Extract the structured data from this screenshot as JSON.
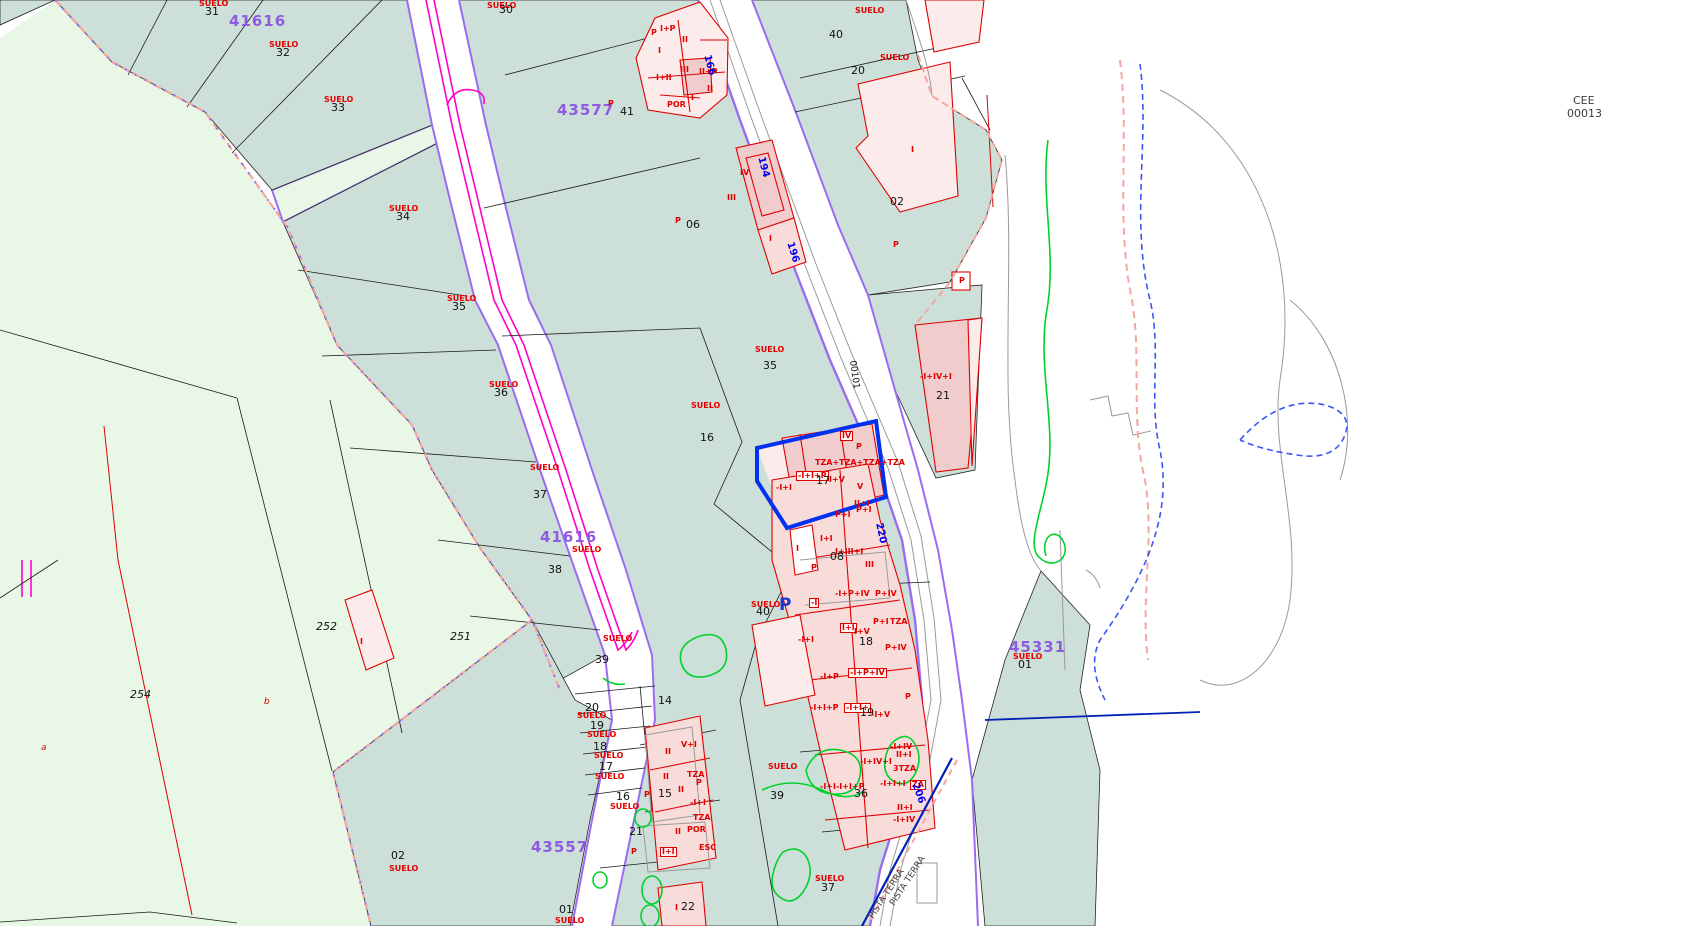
{
  "corner": {
    "line1": "CEE",
    "line2": "00013"
  },
  "selection": {
    "parcel_number": "17",
    "building_label": "I+V",
    "outline_color": "#0030f0"
  },
  "colors": {
    "urban": "#ccdfd8",
    "rural": "#e9f8e6",
    "building": "#f7dcda",
    "building-strong": "#f0cccc",
    "building-light": "#fbeceb",
    "outline-red": "#e00000",
    "suelo-red": "#e80000",
    "violet": "#9a6cf0",
    "block-purple": "#8f5ce0",
    "magenta": "#ff00c8",
    "road-blue": "#0000f0",
    "selection-blue": "#0030f0",
    "navy": "#0020b8",
    "royal": "#3a55f5",
    "green": "#00d22d",
    "boundary-salmon": "#f2a79f",
    "gray": "#9a9a9a",
    "ink": "#111111"
  },
  "labels": [
    {
      "t": "SUELO",
      "x": 199,
      "y": 0,
      "k": "s"
    },
    {
      "t": "31",
      "x": 205,
      "y": 6,
      "k": "n"
    },
    {
      "t": "SUELO",
      "x": 269,
      "y": 41,
      "k": "s"
    },
    {
      "t": "32",
      "x": 276,
      "y": 47,
      "k": "n"
    },
    {
      "t": "SUELO",
      "x": 324,
      "y": 96,
      "k": "s"
    },
    {
      "t": "33",
      "x": 331,
      "y": 102,
      "k": "n"
    },
    {
      "t": "SUELO",
      "x": 389,
      "y": 205,
      "k": "s"
    },
    {
      "t": "34",
      "x": 396,
      "y": 211,
      "k": "n"
    },
    {
      "t": "SUELO",
      "x": 447,
      "y": 295,
      "k": "s"
    },
    {
      "t": "35",
      "x": 452,
      "y": 301,
      "k": "n"
    },
    {
      "t": "SUELO",
      "x": 489,
      "y": 381,
      "k": "s"
    },
    {
      "t": "36",
      "x": 494,
      "y": 387,
      "k": "n"
    },
    {
      "t": "SUELO",
      "x": 530,
      "y": 464,
      "k": "s"
    },
    {
      "t": "37",
      "x": 533,
      "y": 489,
      "k": "n"
    },
    {
      "t": "SUELO",
      "x": 572,
      "y": 546,
      "k": "s"
    },
    {
      "t": "38",
      "x": 548,
      "y": 564,
      "k": "n"
    },
    {
      "t": "SUELO",
      "x": 603,
      "y": 635,
      "k": "s"
    },
    {
      "t": "39",
      "x": 595,
      "y": 654,
      "k": "n"
    },
    {
      "t": "SUELO",
      "x": 487,
      "y": 2,
      "k": "s"
    },
    {
      "t": "30",
      "x": 499,
      "y": 4,
      "k": "n"
    },
    {
      "t": "41616",
      "x": 229,
      "y": 14,
      "k": "b"
    },
    {
      "t": "43577",
      "x": 557,
      "y": 103,
      "k": "b"
    },
    {
      "t": "41616",
      "x": 540,
      "y": 530,
      "k": "b"
    },
    {
      "t": "45331",
      "x": 1009,
      "y": 640,
      "k": "b"
    },
    {
      "t": "43557",
      "x": 531,
      "y": 840,
      "k": "b"
    },
    {
      "t": "SUELO",
      "x": 1013,
      "y": 653,
      "k": "s"
    },
    {
      "t": "01",
      "x": 1018,
      "y": 659,
      "k": "n"
    },
    {
      "t": "P",
      "x": 608,
      "y": 100,
      "k": "c"
    },
    {
      "t": "41",
      "x": 620,
      "y": 106,
      "k": "n"
    },
    {
      "t": "P",
      "x": 675,
      "y": 217,
      "k": "c"
    },
    {
      "t": "06",
      "x": 686,
      "y": 219,
      "k": "n"
    },
    {
      "t": "SUELO",
      "x": 755,
      "y": 346,
      "k": "s"
    },
    {
      "t": "35",
      "x": 763,
      "y": 360,
      "k": "n"
    },
    {
      "t": "SUELO",
      "x": 691,
      "y": 402,
      "k": "s"
    },
    {
      "t": "16",
      "x": 700,
      "y": 432,
      "k": "n"
    },
    {
      "t": "SUELO",
      "x": 855,
      "y": 7,
      "k": "s"
    },
    {
      "t": "40",
      "x": 829,
      "y": 29,
      "k": "n"
    },
    {
      "t": "SUELO",
      "x": 880,
      "y": 54,
      "k": "s"
    },
    {
      "t": "20",
      "x": 851,
      "y": 65,
      "k": "n"
    },
    {
      "t": "02",
      "x": 890,
      "y": 196,
      "k": "n"
    },
    {
      "t": "P",
      "x": 893,
      "y": 241,
      "k": "c"
    },
    {
      "t": "I",
      "x": 911,
      "y": 146,
      "k": "c"
    },
    {
      "t": "P",
      "x": 959,
      "y": 277,
      "k": "c"
    },
    {
      "t": "-I+IV+I",
      "x": 920,
      "y": 373,
      "k": "c"
    },
    {
      "t": "21",
      "x": 936,
      "y": 390,
      "k": "n"
    },
    {
      "t": "P",
      "x": 856,
      "y": 443,
      "k": "c"
    },
    {
      "t": "P",
      "x": 651,
      "y": 29,
      "k": "c"
    },
    {
      "t": "I+P",
      "x": 660,
      "y": 25,
      "k": "c"
    },
    {
      "t": "II",
      "x": 682,
      "y": 36,
      "k": "c"
    },
    {
      "t": "I",
      "x": 658,
      "y": 47,
      "k": "c"
    },
    {
      "t": "I+II",
      "x": 656,
      "y": 74,
      "k": "c"
    },
    {
      "t": "III",
      "x": 680,
      "y": 66,
      "k": "c"
    },
    {
      "t": "II+P",
      "x": 699,
      "y": 68,
      "k": "c"
    },
    {
      "t": "I",
      "x": 691,
      "y": 94,
      "k": "c"
    },
    {
      "t": "II",
      "x": 707,
      "y": 85,
      "k": "c"
    },
    {
      "t": "POR",
      "x": 667,
      "y": 101,
      "k": "c"
    },
    {
      "t": "IV",
      "x": 740,
      "y": 169,
      "k": "c"
    },
    {
      "t": "III",
      "x": 727,
      "y": 194,
      "k": "c"
    },
    {
      "t": "I",
      "x": 769,
      "y": 235,
      "k": "c"
    },
    {
      "t": "TZA+TZA+TZA+TZA",
      "x": 815,
      "y": 459,
      "k": "c"
    },
    {
      "t": "-I+I+P",
      "x": 796,
      "y": 471,
      "k": "cb"
    },
    {
      "t": "17",
      "x": 816,
      "y": 475,
      "k": "n"
    },
    {
      "t": "I+V",
      "x": 829,
      "y": 476,
      "k": "c"
    },
    {
      "t": "-I+I",
      "x": 776,
      "y": 484,
      "k": "c"
    },
    {
      "t": "IV",
      "x": 840,
      "y": 431,
      "k": "cb"
    },
    {
      "t": "V",
      "x": 857,
      "y": 483,
      "k": "c"
    },
    {
      "t": "II+I",
      "x": 854,
      "y": 500,
      "k": "c"
    },
    {
      "t": "P+I",
      "x": 835,
      "y": 511,
      "k": "c"
    },
    {
      "t": "P+I",
      "x": 856,
      "y": 506,
      "k": "c"
    },
    {
      "t": "I+I",
      "x": 820,
      "y": 535,
      "k": "c"
    },
    {
      "t": "I+III+I",
      "x": 835,
      "y": 548,
      "k": "c"
    },
    {
      "t": "I",
      "x": 796,
      "y": 545,
      "k": "c"
    },
    {
      "t": "P",
      "x": 811,
      "y": 564,
      "k": "c"
    },
    {
      "t": "III",
      "x": 865,
      "y": 561,
      "k": "c"
    },
    {
      "t": "08",
      "x": 830,
      "y": 551,
      "k": "n"
    },
    {
      "t": "SUELO",
      "x": 751,
      "y": 601,
      "k": "s"
    },
    {
      "t": "40",
      "x": 756,
      "y": 606,
      "k": "n"
    },
    {
      "t": "P",
      "x": 779,
      "y": 597,
      "k": "bp"
    },
    {
      "t": "-I",
      "x": 809,
      "y": 598,
      "k": "cb"
    },
    {
      "t": "-I+P+IV",
      "x": 835,
      "y": 590,
      "k": "c"
    },
    {
      "t": "P+IV",
      "x": 875,
      "y": 590,
      "k": "c"
    },
    {
      "t": "P+I",
      "x": 873,
      "y": 618,
      "k": "c"
    },
    {
      "t": "TZA",
      "x": 890,
      "y": 618,
      "k": "c"
    },
    {
      "t": "I+I",
      "x": 840,
      "y": 623,
      "k": "cb"
    },
    {
      "t": "I+V",
      "x": 854,
      "y": 628,
      "k": "c"
    },
    {
      "t": "18",
      "x": 859,
      "y": 636,
      "k": "n"
    },
    {
      "t": "-I+I",
      "x": 798,
      "y": 636,
      "k": "c"
    },
    {
      "t": "P+IV",
      "x": 885,
      "y": 644,
      "k": "c"
    },
    {
      "t": "-I+P+IV",
      "x": 848,
      "y": 668,
      "k": "cb"
    },
    {
      "t": "-I+P",
      "x": 820,
      "y": 673,
      "k": "c"
    },
    {
      "t": "-I+I+P",
      "x": 810,
      "y": 704,
      "k": "c"
    },
    {
      "t": "-I+I+",
      "x": 844,
      "y": 703,
      "k": "cb"
    },
    {
      "t": "19",
      "x": 860,
      "y": 707,
      "k": "n"
    },
    {
      "t": "-I+V",
      "x": 871,
      "y": 711,
      "k": "c"
    },
    {
      "t": "P",
      "x": 905,
      "y": 693,
      "k": "c"
    },
    {
      "t": "-I+IV",
      "x": 890,
      "y": 743,
      "k": "c"
    },
    {
      "t": "II+I",
      "x": 896,
      "y": 751,
      "k": "c"
    },
    {
      "t": "-I+IV+I",
      "x": 860,
      "y": 758,
      "k": "c"
    },
    {
      "t": "3TZA",
      "x": 893,
      "y": 765,
      "k": "c"
    },
    {
      "t": "-I+I+I",
      "x": 880,
      "y": 780,
      "k": "c"
    },
    {
      "t": "ZA",
      "x": 910,
      "y": 780,
      "k": "cb"
    },
    {
      "t": "-I+I-I+I+P",
      "x": 820,
      "y": 783,
      "k": "c"
    },
    {
      "t": "36",
      "x": 854,
      "y": 788,
      "k": "n"
    },
    {
      "t": "II+I",
      "x": 897,
      "y": 804,
      "k": "c"
    },
    {
      "t": "-I+IV",
      "x": 893,
      "y": 816,
      "k": "c"
    },
    {
      "t": "SUELO",
      "x": 768,
      "y": 763,
      "k": "s"
    },
    {
      "t": "39",
      "x": 770,
      "y": 790,
      "k": "n"
    },
    {
      "t": "SUELO",
      "x": 815,
      "y": 875,
      "k": "s"
    },
    {
      "t": "37",
      "x": 821,
      "y": 882,
      "k": "n"
    },
    {
      "t": "14",
      "x": 658,
      "y": 695,
      "k": "n"
    },
    {
      "t": "15",
      "x": 658,
      "y": 788,
      "k": "n"
    },
    {
      "t": "20",
      "x": 585,
      "y": 702,
      "k": "n"
    },
    {
      "t": "SUELO",
      "x": 577,
      "y": 712,
      "k": "s"
    },
    {
      "t": "19",
      "x": 590,
      "y": 720,
      "k": "n"
    },
    {
      "t": "SUELO",
      "x": 587,
      "y": 731,
      "k": "s"
    },
    {
      "t": "18",
      "x": 593,
      "y": 741,
      "k": "n"
    },
    {
      "t": "SUELO",
      "x": 594,
      "y": 752,
      "k": "s"
    },
    {
      "t": "17",
      "x": 599,
      "y": 761,
      "k": "n"
    },
    {
      "t": "SUELO",
      "x": 595,
      "y": 773,
      "k": "s"
    },
    {
      "t": "16",
      "x": 616,
      "y": 791,
      "k": "n"
    },
    {
      "t": "SUELO",
      "x": 610,
      "y": 803,
      "k": "s"
    },
    {
      "t": "21",
      "x": 629,
      "y": 826,
      "k": "n"
    },
    {
      "t": "II",
      "x": 665,
      "y": 748,
      "k": "c"
    },
    {
      "t": "V+I",
      "x": 681,
      "y": 741,
      "k": "c"
    },
    {
      "t": "II",
      "x": 663,
      "y": 773,
      "k": "c"
    },
    {
      "t": "TZA",
      "x": 687,
      "y": 771,
      "k": "c"
    },
    {
      "t": "P",
      "x": 696,
      "y": 779,
      "k": "c"
    },
    {
      "t": "II",
      "x": 678,
      "y": 786,
      "k": "c"
    },
    {
      "t": "P",
      "x": 644,
      "y": 791,
      "k": "c"
    },
    {
      "t": "-I+I",
      "x": 690,
      "y": 799,
      "k": "c"
    },
    {
      "t": "TZA",
      "x": 693,
      "y": 814,
      "k": "c"
    },
    {
      "t": "II",
      "x": 675,
      "y": 828,
      "k": "c"
    },
    {
      "t": "POR",
      "x": 687,
      "y": 826,
      "k": "c"
    },
    {
      "t": "ESC",
      "x": 699,
      "y": 844,
      "k": "c"
    },
    {
      "t": "I+I",
      "x": 660,
      "y": 847,
      "k": "cb"
    },
    {
      "t": "P",
      "x": 631,
      "y": 848,
      "k": "c"
    },
    {
      "t": "01",
      "x": 559,
      "y": 904,
      "k": "n"
    },
    {
      "t": "SUELO",
      "x": 555,
      "y": 917,
      "k": "s"
    },
    {
      "t": "I",
      "x": 675,
      "y": 904,
      "k": "c"
    },
    {
      "t": "22",
      "x": 681,
      "y": 901,
      "k": "n"
    },
    {
      "t": "02",
      "x": 391,
      "y": 850,
      "k": "n"
    },
    {
      "t": "SUELO",
      "x": 389,
      "y": 865,
      "k": "s"
    },
    {
      "t": "251",
      "x": 450,
      "y": 631,
      "k": "ni"
    },
    {
      "t": "252",
      "x": 316,
      "y": 621,
      "k": "ni"
    },
    {
      "t": "254",
      "x": 130,
      "y": 689,
      "k": "ni"
    },
    {
      "t": "a",
      "x": 41,
      "y": 744,
      "k": "l"
    },
    {
      "t": "b",
      "x": 264,
      "y": 698,
      "k": "l"
    },
    {
      "t": "I",
      "x": 360,
      "y": 638,
      "k": "c"
    },
    {
      "t": "166",
      "x": 711,
      "y": 54,
      "k": "r",
      "r": 75
    },
    {
      "t": "194",
      "x": 765,
      "y": 156,
      "k": "r",
      "r": 75
    },
    {
      "t": "196",
      "x": 794,
      "y": 241,
      "k": "r",
      "r": 73
    },
    {
      "t": "220",
      "x": 883,
      "y": 522,
      "k": "r",
      "r": 78
    },
    {
      "t": "206",
      "x": 919,
      "y": 782,
      "k": "r",
      "r": 70
    },
    {
      "t": "00101",
      "x": 856,
      "y": 360,
      "k": "rb",
      "r": 82
    },
    {
      "t": "PISTA TERRA",
      "x": 868,
      "y": 916,
      "k": "g",
      "r": -57
    },
    {
      "t": "PISTA TERRA",
      "x": 889,
      "y": 903,
      "k": "g",
      "r": -57
    }
  ]
}
